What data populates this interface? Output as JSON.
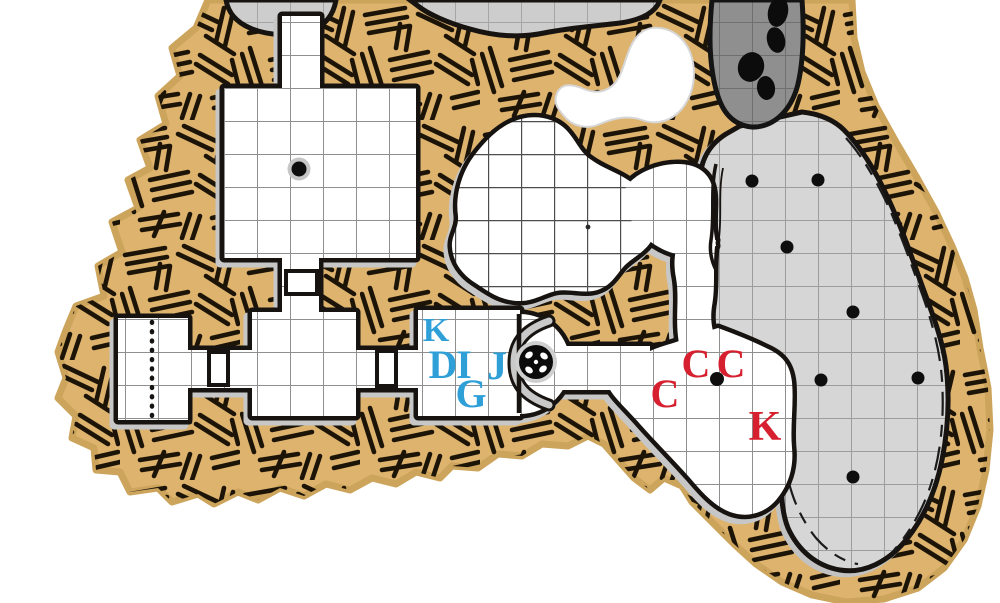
{
  "map": {
    "labels": [
      {
        "text": "K",
        "color": "blue"
      },
      {
        "text": "D",
        "color": "blue"
      },
      {
        "text": "I",
        "color": "blue"
      },
      {
        "text": "J",
        "color": "blue"
      },
      {
        "text": "G",
        "color": "blue"
      },
      {
        "text": "C",
        "color": "red"
      },
      {
        "text": "C",
        "color": "red"
      },
      {
        "text": "C",
        "color": "red"
      },
      {
        "text": "K",
        "color": "red"
      }
    ],
    "colors": {
      "page": "#ffffff",
      "rock": "#ddb36e",
      "hatch": "#1d1408",
      "outline": "#161310",
      "room": "#ffffff",
      "cavern": "#d6d6d6",
      "dark_passage": "#8f8f8f",
      "grid": "#8f8f8f",
      "blue_label": "#2f9fd8",
      "red_label": "#d6202f"
    },
    "markers": {
      "doors": 3,
      "secret_dotted_line": 1,
      "round_pillar_dots": 1,
      "dark_orb_statue": 1,
      "boulders": 4,
      "cavern_stalagmite_dots": 7,
      "floor_dot": 1
    }
  }
}
